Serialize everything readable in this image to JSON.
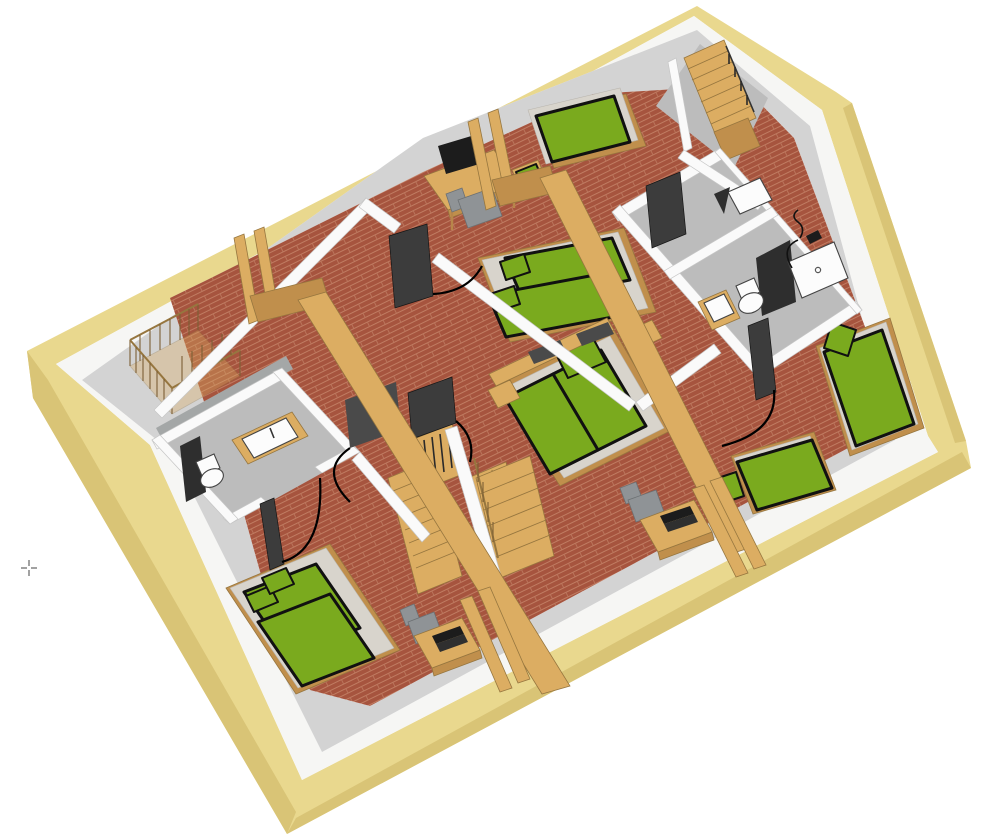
{
  "scene": {
    "title": "3D cutaway floor plan of an attic storey",
    "view": "isometric cutaway seen from above",
    "canvas": {
      "width": 1000,
      "height": 839
    },
    "background": "#ffffff"
  },
  "palette": {
    "roof_yellow": "#E9D88E",
    "roof_yellow_dark": "#D9C476",
    "plate_white": "#F6F6F4",
    "slope_gray": "#D3D3D3",
    "floor_red": "#A6543E",
    "floor_red_line": "#C07C62",
    "floor_gray": "#BCBCBC",
    "wall_white": "#FAFAFA",
    "wall_edge": "#C6C6C6",
    "halfwall_gray": "#A4A7A7",
    "wood": "#DCAD62",
    "wood_dark": "#C08F4C",
    "wood_edge": "#96763F",
    "bed_green": "#7AAA1E",
    "platform_gray": "#D8D4CC",
    "outline_black": "#111111",
    "door_dark": "#3C3C3C",
    "chair_gray": "#8F9396",
    "fixture_white": "#FCFCFC"
  },
  "inventory": {
    "bedrooms": 4,
    "bathrooms": 2,
    "staircases": 2,
    "beds_double": 3,
    "beds_single": 3,
    "baby_cribs": 1,
    "desks": 3,
    "office_chairs": 3,
    "rooms": [
      {
        "id": "room-top-left",
        "type": "open-room",
        "furniture": [
          "baby-crib",
          "roof-posts"
        ]
      },
      {
        "id": "room-top-middle",
        "type": "bedroom",
        "furniture": [
          "single-bed",
          "nightstand-stool",
          "desk",
          "monitor",
          "office-chair",
          "double-bed"
        ]
      },
      {
        "id": "room-central",
        "type": "bedroom",
        "furniture": [
          "double-bed",
          "nightstand",
          "nightstand",
          "desk",
          "laptop",
          "office-chair",
          "wardrobe"
        ]
      },
      {
        "id": "room-right",
        "type": "bedroom",
        "furniture": [
          "single-bed",
          "single-bed",
          "stool",
          "stool"
        ]
      },
      {
        "id": "room-bottom-left",
        "type": "bedroom",
        "furniture": [
          "double-bed",
          "desk",
          "laptop",
          "office-chair"
        ]
      },
      {
        "id": "bathroom-top-right",
        "type": "bathroom",
        "fixtures": [
          "shower",
          "toilet",
          "sink"
        ]
      },
      {
        "id": "wc-top-right",
        "type": "washroom",
        "fixtures": [
          "sink"
        ]
      },
      {
        "id": "bathroom-left",
        "type": "bathroom",
        "fixtures": [
          "sink",
          "toilet"
        ]
      },
      {
        "id": "stairwell-top-right",
        "type": "staircase"
      },
      {
        "id": "stairs-central",
        "type": "staircase"
      }
    ]
  },
  "cursor": {
    "x": 29,
    "y": 568,
    "shape": "crosshair"
  }
}
